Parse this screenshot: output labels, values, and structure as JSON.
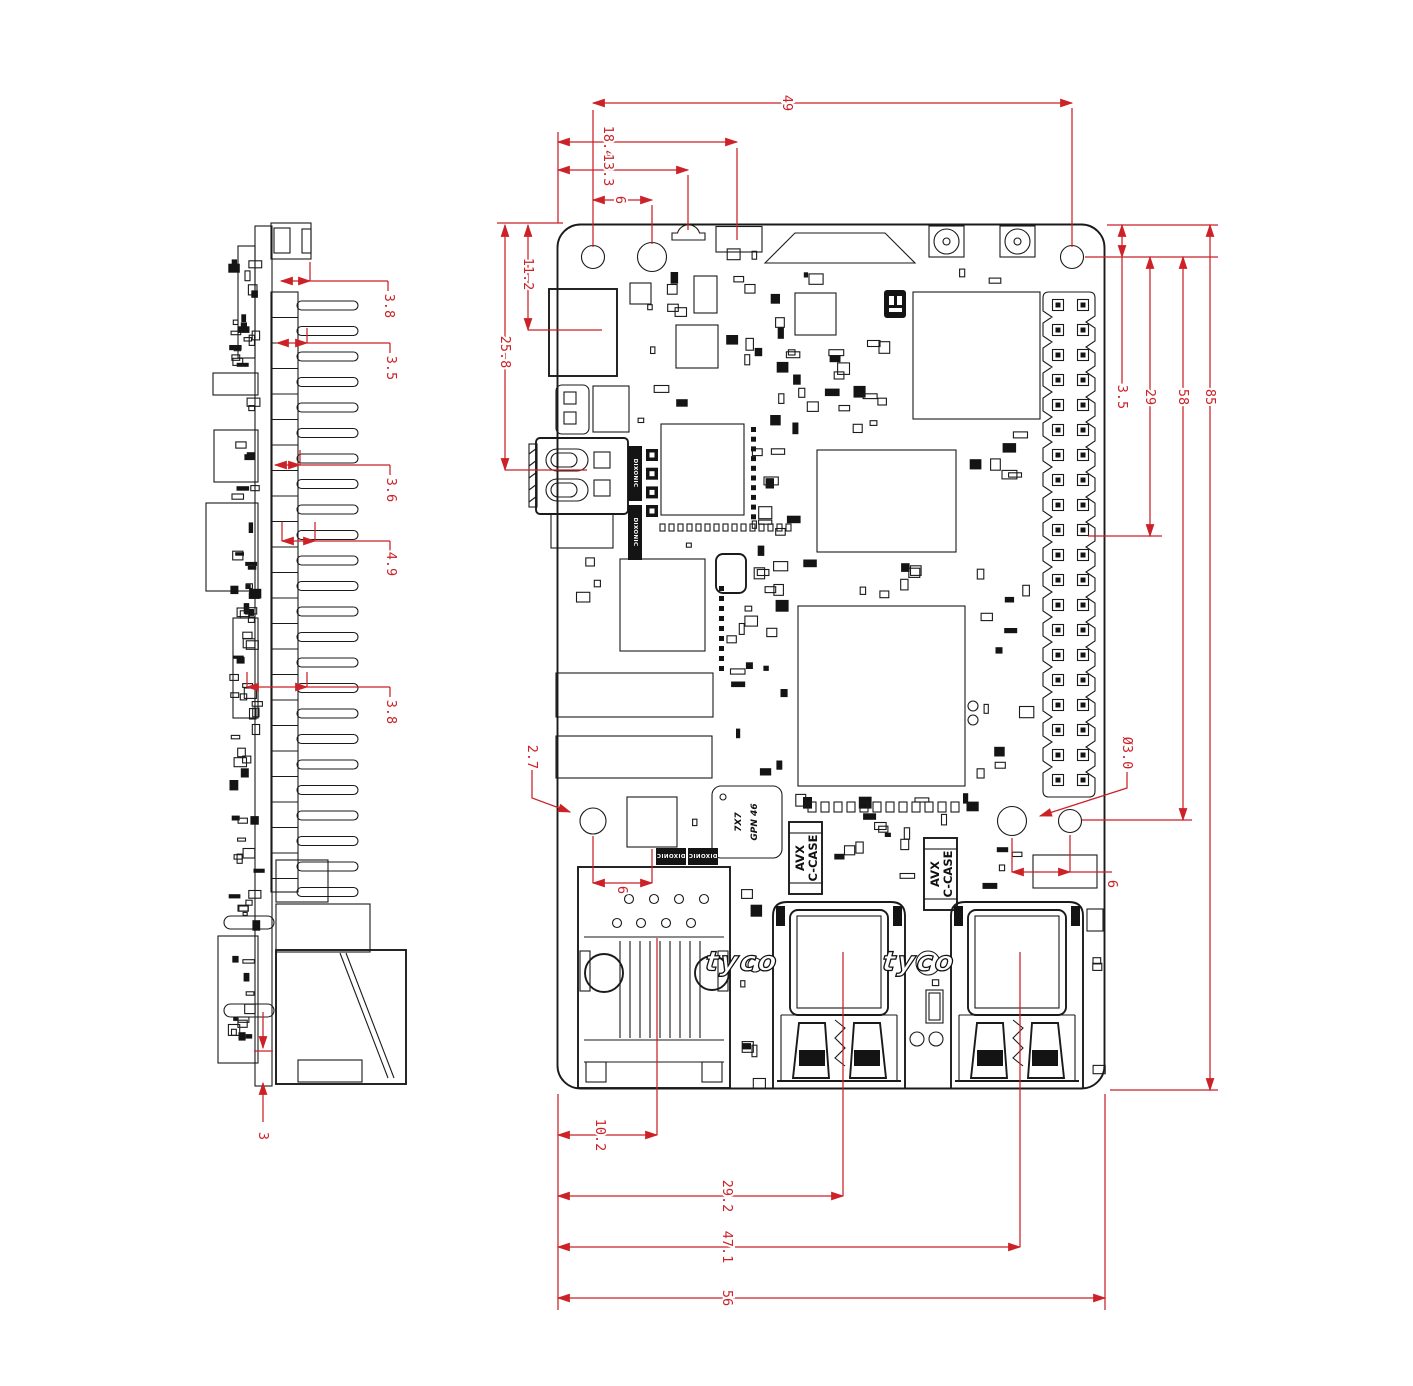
{
  "dims": {
    "top_width_49": "49",
    "top_18_4": "18.4",
    "top_13_3": "13.3",
    "top_hole_6": "6",
    "left_11_2": "11.2",
    "left_25_8": "25.8",
    "hole_offset_2_7": "2.7",
    "right_3_5": "3.5",
    "right_29": "29",
    "right_58": "58",
    "right_85": "85",
    "hole_dia_3_0": "Ø3.0",
    "right_hole_6": "6",
    "eth_hole_6": "6",
    "bottom_10_2": "10.2",
    "bottom_29_2": "29.2",
    "bottom_47_1": "47.1",
    "bottom_56": "56",
    "side_3_8_top": "3.8",
    "side_3_5": "3.5",
    "side_3_6": "3.6",
    "side_4_9": "4.9",
    "side_3_8_mid": "3.8",
    "side_3": "3"
  },
  "labels": {
    "usb_brand": "tyco",
    "cap_brand": "AVX",
    "cap_series": "C-CASE",
    "ic_marking_line1": "GPN 46",
    "ic_marking_line2": "7X7",
    "silkscreen_tag": "DIXONIC"
  }
}
